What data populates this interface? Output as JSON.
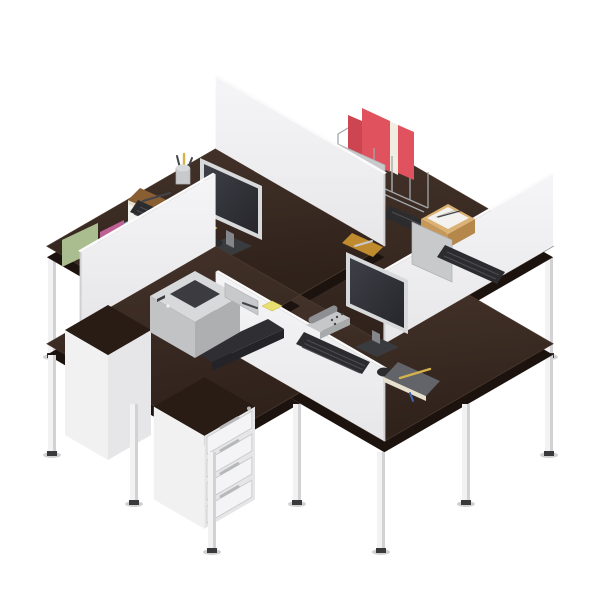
{
  "meta": {
    "alt": "Isometric render of a four-person office workstation cluster: dark wenge L-shaped desks arranged in a pinwheel cross with white privacy dividers, two visible monitors, keyboards, a desktop printer, white drawer pedestals, red binders in a wire rack, a wooden paper tray, file boxes and desk accessories",
    "workstation_count": 4,
    "drawer_count": 4
  },
  "inventory": [
    "desk-back-left",
    "desk-back-right",
    "desk-front-right",
    "desk-front-left",
    "divider-panel-nw",
    "divider-panel-ne",
    "divider-panel-se",
    "divider-panel-sw",
    "monitor-back-left",
    "monitor-front",
    "monitor-back-far-nw",
    "monitor-back-far-ne",
    "keyboard-x4",
    "mouse-x2",
    "printer",
    "printer-output-tray",
    "pedestal-4-drawers",
    "pedestal-plain",
    "red-binders-wire-rack",
    "wooden-paper-tray",
    "pen-cup",
    "brown-notebook",
    "gray-notebook",
    "tan-notepad",
    "sticky-notes-x3",
    "cordless-phone",
    "file-box-green",
    "file-box-pink",
    "file-box-teal",
    "document-stack"
  ],
  "colors": {
    "desk_top": "#2f221b",
    "desk_top_hi": "#44332a",
    "desk_rim": "#1c130e",
    "desk_edge": "#4a392d",
    "panel": "#e7e7e9",
    "panel_hi": "#f5f5f7",
    "panel_top": "#fbfbfc",
    "panel_edge": "#d0d0d3",
    "leg": "#f2f2f3",
    "leg_shade": "#d2d2d4",
    "foot": "#3a3a3c",
    "shadow": "#000000",
    "bezel": "#d8d9db",
    "screen": "#26262b",
    "screen_hi": "#3e4048",
    "neck": "#85868a",
    "stand": "#3a3b3f",
    "dark_device": "#2c2c2f",
    "key_line": "#4b4c50",
    "metal": "#c8c9cb",
    "metal_edge": "#aeafb2",
    "ped_body": "#f1f1f2",
    "ped_side": "#e6e6e8",
    "ped_top": "#281c15",
    "drawer": "#f4f4f6",
    "drawer_gap": "#c7c8ca",
    "handle": "#b7b8ba",
    "printer_body": "#c2c3c5",
    "printer_top": "#d8d9db",
    "printer_side": "#aeafb1",
    "printer_slot": "#3c3c40",
    "tray_dark": "#2f2f33",
    "tray_lip": "#242428",
    "binder_red": "#e0525e",
    "binder_red2": "#cc4550",
    "pages": "#f1ede3",
    "wire": "#a2a6aa",
    "wood_tray": "#dcb274",
    "wood_side": "#c69859",
    "wood_side2": "#b5874a",
    "paper": "#f3f2ee",
    "paper_line": "#b9b5a9",
    "notebook_brown": "#8a5e33",
    "notebook_gray": "#63646a",
    "page_edge": "#e6e0cf",
    "box_green": "#a9bd8f",
    "box_pink": "#bf5f94",
    "box_teal": "#7aa7bd",
    "sticky": "#eadf72",
    "sticky_edge": "#cfc254",
    "pad_tan": "#c08a2e",
    "phone": "#c6c7c9",
    "phone_side": "#a9aaac",
    "handset": "#8e8f93",
    "pen_yellow": "#d4b34a",
    "pen_dark": "#44454a",
    "ribbon_blue": "#3f63b5"
  }
}
